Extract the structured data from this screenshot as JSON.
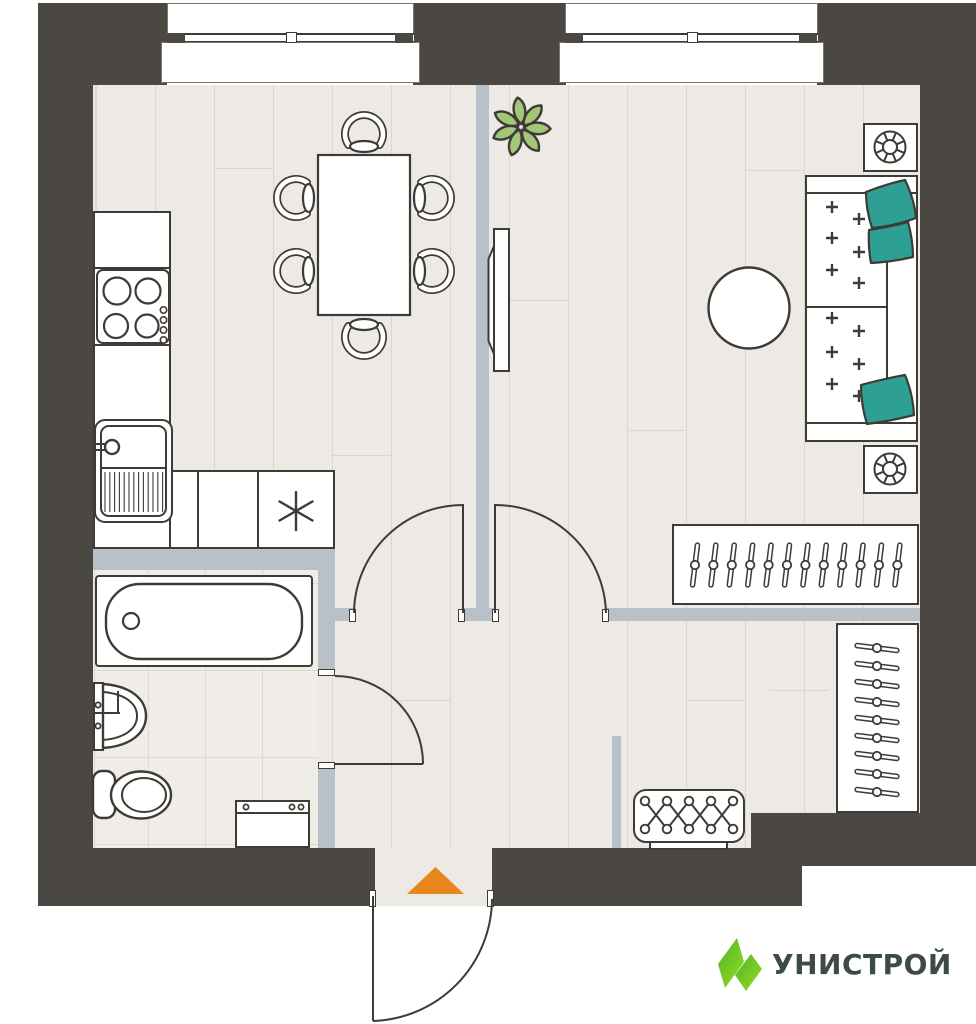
{
  "brand": {
    "name": "УНИСТРОЙ",
    "logo_icon": "unistroy-green-parallelograms-icon"
  },
  "colors": {
    "wall_dark": "#4B4742",
    "partition": "#B7C1C7",
    "floor_main": "#EDE9E4",
    "floor_line": "#DCD5CF",
    "floor_bath": "#F0EDE9",
    "tile_line": "#DFD9D3",
    "outline": "#3E3B37",
    "teal": "#2EA093",
    "orange": "#E8861D",
    "plant_green": "#A3C678",
    "logo_green_1": "#52B42D",
    "logo_green_2": "#96DB1F",
    "logo_text": "#3D4A45"
  },
  "plan": {
    "type": "apartment-floor-plan",
    "rooms": [
      {
        "name": "kitchen-living-room"
      },
      {
        "name": "bedroom"
      },
      {
        "name": "bathroom"
      },
      {
        "name": "hallway"
      }
    ],
    "furniture_icons": [
      "kitchen-counter-icon",
      "stove-icon",
      "kitchen-sink-icon",
      "refrigerator-snowflake-icon",
      "dining-table-icon",
      "chair-icon-x6",
      "plant-icon",
      "tv-icon",
      "pouf-icon",
      "double-bed-icon",
      "pillow-icon-x3",
      "nightstand-lamp-icon-x2",
      "wardrobe-hangers-icon-x12",
      "closet-hangers-icon-x9",
      "bench-icon",
      "bathtub-icon",
      "washbasin-icon",
      "toilet-icon",
      "washing-machine-icon",
      "entrance-arrow-icon",
      "door-swing-icon-x4",
      "window-icon-x2"
    ]
  }
}
